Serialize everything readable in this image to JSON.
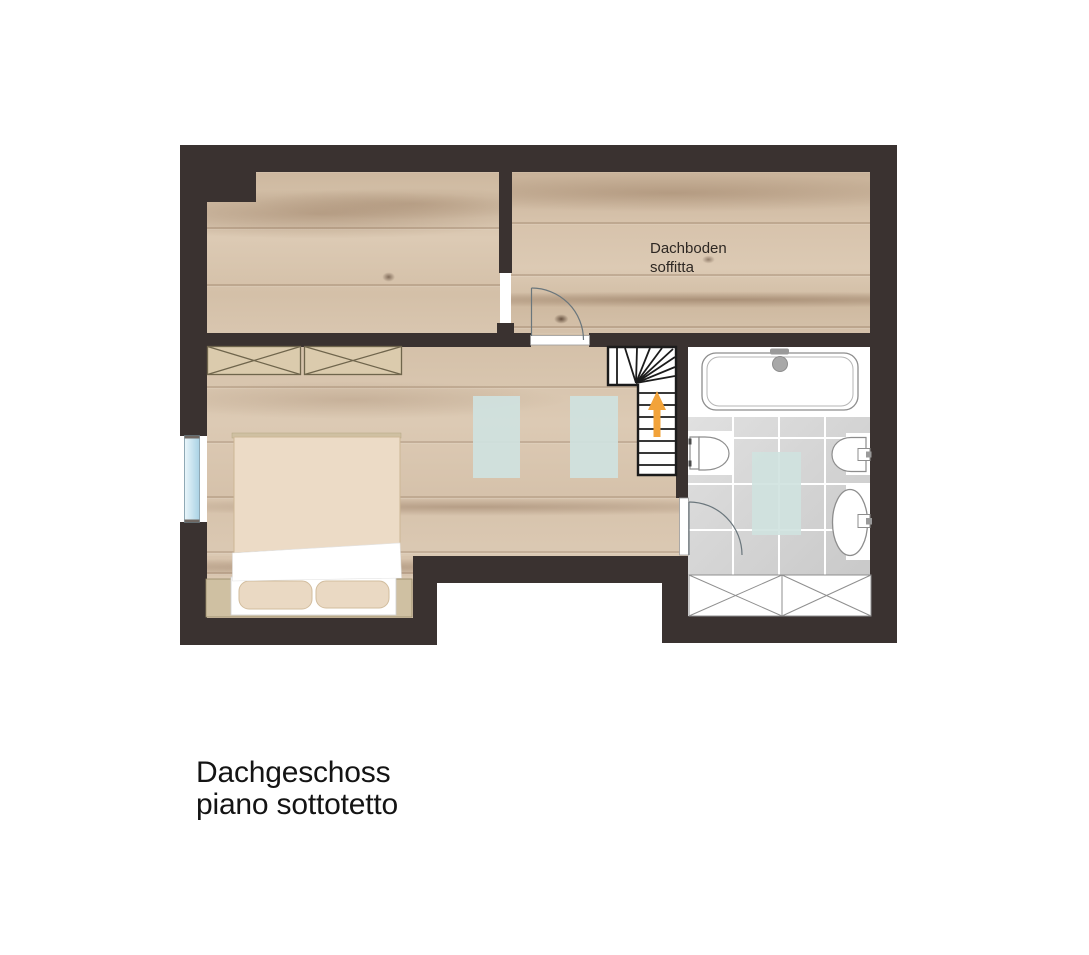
{
  "plan": {
    "room_labels": [
      {
        "id": "attic",
        "line1": "Dachboden",
        "line2": "soffitta"
      }
    ]
  },
  "caption": {
    "line1": "Dachgeschoss",
    "line2": "piano sottotetto"
  },
  "colors": {
    "background": "#ffffff",
    "wall": "#3a3230",
    "wood_base": "#d8c5ae",
    "tile": "#d4d4d4",
    "grout": "#ffffff",
    "skylight": "#cfe2df",
    "window_glass": "#c3e0ee",
    "arrow": "#f2a33a",
    "fixture_line": "#8d8d8d",
    "stair_line": "#1b1b1b",
    "door_line": "#6a767c",
    "wardrobe_fill": "#dbcbad",
    "wardrobe_line": "#6f654c",
    "bed_frame": "#cfc0a2",
    "bed_duvet": "#ecdbc6",
    "bed_pillow": "#ead9c3",
    "label_text": "#2e2823",
    "caption_text": "#141414"
  }
}
